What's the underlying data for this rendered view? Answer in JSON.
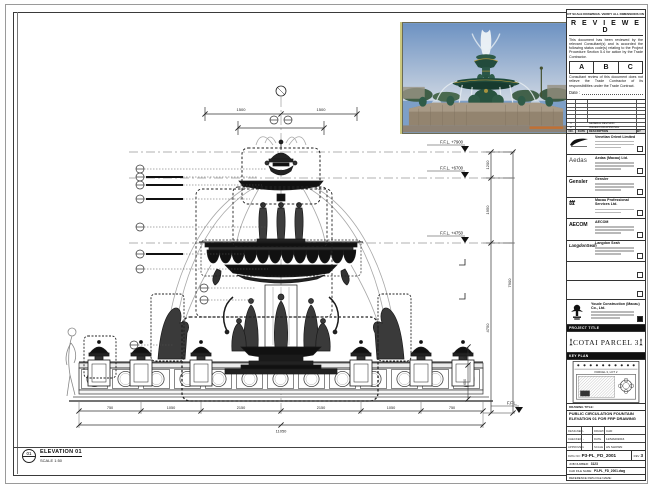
{
  "drawing": {
    "elevation": {
      "bubble": "01",
      "title": "ELEVATION 01",
      "scale": "SCALE 1:50"
    },
    "levels": [
      "F.F.L. +7900",
      "F.F.L. +6700",
      "F.F.L. +4750",
      "F.F.L."
    ],
    "dims": {
      "top": [
        "1500",
        "1500"
      ],
      "right": [
        "1200",
        "1950",
        "4750",
        "7900"
      ],
      "wall": [
        "450",
        "650"
      ],
      "bottom": [
        "750",
        "1050",
        "2150",
        "2150",
        "1050",
        "750"
      ],
      "overall": "11050"
    }
  },
  "stamp": {
    "top_note": "DO NOT SCALE DRAWINGS. VERIFY ALL DIMENSIONS ON SITE.",
    "title": "R E V I E W E D",
    "para1": "This document has been reviewed by the relevant Consultant(s) and is accorded the following status code(s) relating to the Project Procedure Section 5.4 for action by the Trade Contractor.",
    "codes": [
      "A",
      "B",
      "C"
    ],
    "para2": "Consultant review of this document does not relieve the Trade Contractor of its responsibilities under the Trade Contract.",
    "date_label": "Date :"
  },
  "revisions": {
    "header": [
      "NO.",
      "DATE",
      "DESCRIPTION",
      "BY"
    ],
    "rows": [
      {
        "no": "1",
        "date": "",
        "desc": "GENERAL REVISION",
        "by": ""
      },
      {
        "no": "2",
        "date": "",
        "desc": "ISSUED FOR APPROVAL",
        "by": ""
      }
    ]
  },
  "consultants": [
    {
      "logo": "Venetian",
      "name": "Venetian Orient Limited"
    },
    {
      "logo": "Aedas",
      "name": "Aedas (Macau) Ltd."
    },
    {
      "logo": "Gensler",
      "name": "Gensler"
    },
    {
      "logo": "ttt",
      "name": "Macau Professional Services Ltd."
    },
    {
      "logo": "AECOM",
      "name": "AECOM"
    },
    {
      "logo": "LangdonSeah",
      "name": "Langdon Seah"
    }
  ],
  "contractor": {
    "name": "Youde Construction (Macau) Co., Ltd."
  },
  "project": {
    "label": "PROJECT TITLE",
    "name": "COTAI PARCEL 3"
  },
  "key_plan": {
    "label": "KEY PLAN",
    "annotation": "PARCEL 3, LOT 2"
  },
  "title_block": {
    "drawing_title_label": "DRAWING TITLE:",
    "drawing_title": "PUBLIC CIRCULATION FOUNTAIN ELEVATION 01 FOR FRP DRAWING",
    "fields": {
      "designed_label": "DESIGNED",
      "designed": "-",
      "drawn_label": "DRAWN",
      "drawn": "CAD",
      "checked_label": "CHECKED",
      "checked": "-",
      "date_label": "DATE",
      "date": "12/MAR/2016",
      "approved_label": "APPROVED",
      "approved": "-",
      "scale_label": "SCALE",
      "scale": "AS SHOWN"
    },
    "dwg_no_label": "DWG NO:",
    "dwg_no": "P3-PL_FD_2001",
    "rev_label": "REV",
    "rev": "3",
    "job_label": "JOB NUMBER:",
    "job": "3123",
    "cad_label": "CAD FILE NAME:",
    "cad": "P3-PL_FD_2001.dwg",
    "ref_label": "REFERENCE DWG FILE NAME:"
  }
}
